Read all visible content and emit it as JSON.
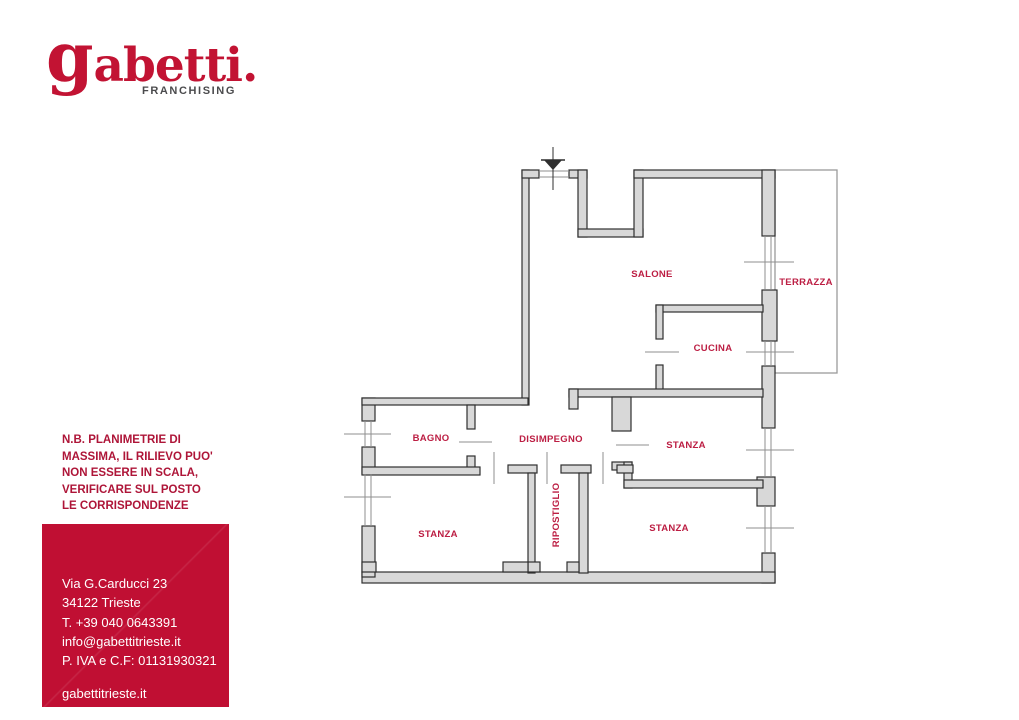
{
  "brand": {
    "logo_g": "g",
    "logo_rest": "abetti.",
    "franchising": "FRANCHISING",
    "logo_color": "#C21333",
    "franchising_color": "#4B4B4D"
  },
  "disclaimer": {
    "color": "#AE1538",
    "lines": [
      "N.B. PLANIMETRIE DI",
      "MASSIMA, IL RILIEVO PUO'",
      "NON ESSERE IN SCALA,",
      "VERIFICARE SUL POSTO",
      "LE CORRISPONDENZE"
    ]
  },
  "contact_box": {
    "bg_color": "#C00F33",
    "lines": [
      "Via G.Carducci 23",
      "34122 Trieste",
      "T. +39 040 0643391",
      "info@gabettitrieste.it",
      "P. IVA e C.F: 01131930321"
    ],
    "website": "gabettitrieste.it"
  },
  "floor_plan": {
    "wall_fill": "#D8D8D8",
    "wall_stroke": "#2F2F2F",
    "thin_line_color": "#8F8F8F",
    "label_color": "#BC1E43",
    "rooms": [
      {
        "id": "salone",
        "label": "SALONE"
      },
      {
        "id": "terrazza",
        "label": "TERRAZZA"
      },
      {
        "id": "cucina",
        "label": "CUCINA"
      },
      {
        "id": "bagno",
        "label": "BAGNO"
      },
      {
        "id": "disimpegno",
        "label": "DISIMPEGNO"
      },
      {
        "id": "stanza-mid-right",
        "label": "STANZA"
      },
      {
        "id": "ripostiglio",
        "label": "RIPOSTIGLIO"
      },
      {
        "id": "stanza-bottom-left",
        "label": "STANZA"
      },
      {
        "id": "stanza-bottom-right",
        "label": "STANZA"
      }
    ]
  }
}
